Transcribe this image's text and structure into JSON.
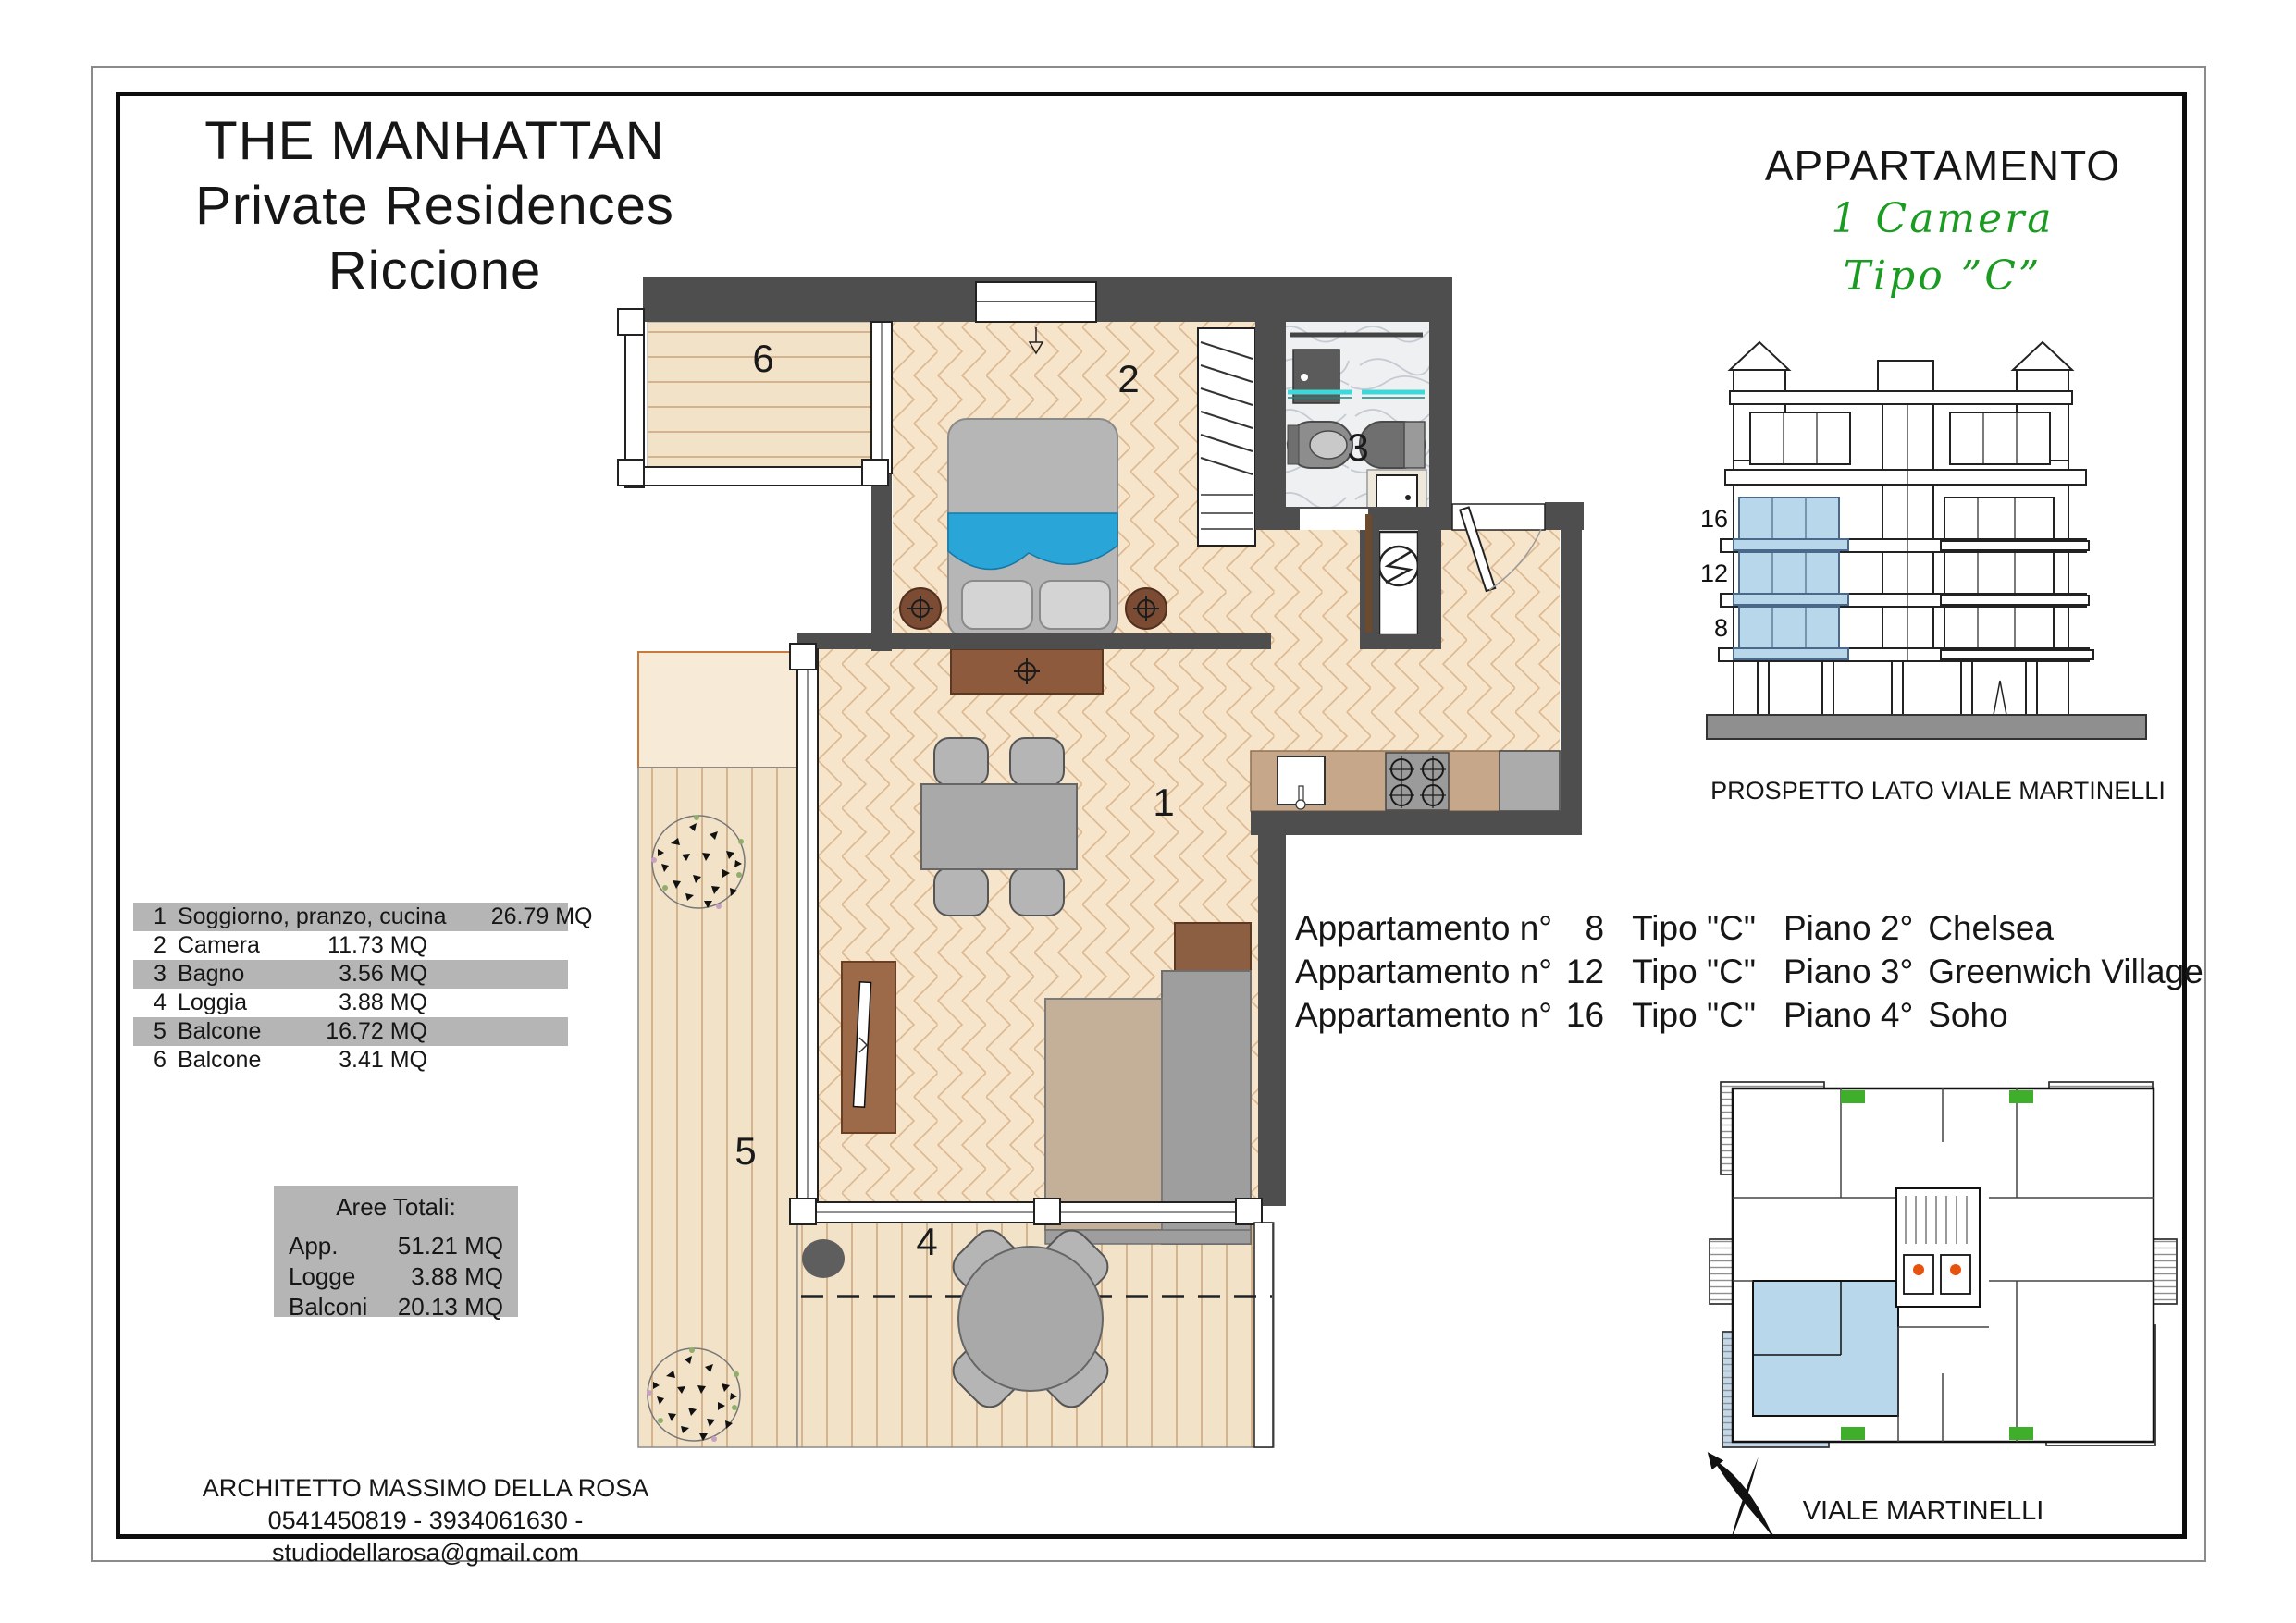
{
  "title": {
    "lines": [
      "THE MANHATTAN",
      "Private Residences",
      "Riccione"
    ]
  },
  "header_right": {
    "title": "APPARTAMENTO",
    "rooms_line": "1  Camera",
    "type_line": "Tipo  ”C”"
  },
  "elevation": {
    "caption": "PROSPETTO LATO VIALE MARTINELLI",
    "floors": [
      "16",
      "12",
      "8"
    ]
  },
  "legend": {
    "rows": [
      {
        "num": "1",
        "name": "Soggiorno, pranzo, cucina",
        "area": "26.79 MQ"
      },
      {
        "num": "2",
        "name": "Camera",
        "area": "11.73 MQ"
      },
      {
        "num": "3",
        "name": "Bagno",
        "area": "3.56 MQ"
      },
      {
        "num": "4",
        "name": "Loggia",
        "area": "3.88 MQ"
      },
      {
        "num": "5",
        "name": "Balcone",
        "area": "16.72 MQ"
      },
      {
        "num": "6",
        "name": "Balcone",
        "area": "3.41 MQ"
      }
    ]
  },
  "totals": {
    "title": "Aree Totali:",
    "rows": [
      {
        "label": "App.",
        "value": "51.21 MQ"
      },
      {
        "label": "Logge",
        "value": "3.88 MQ"
      },
      {
        "label": "Balconi",
        "value": "20.13 MQ"
      }
    ]
  },
  "apartments": {
    "rows": [
      {
        "prefix": "Appartamento n°",
        "num": "8",
        "tipo": "Tipo \"C\"",
        "piano": "Piano 2°",
        "zone": "Chelsea"
      },
      {
        "prefix": "Appartamento n°",
        "num": "12",
        "tipo": "Tipo \"C\"",
        "piano": "Piano 3°",
        "zone": "Greenwich Village"
      },
      {
        "prefix": "Appartamento n°",
        "num": "16",
        "tipo": "Tipo \"C\"",
        "piano": "Piano 4°",
        "zone": "Soho"
      }
    ]
  },
  "architect": {
    "name": "ARCHITETTO MASSIMO DELLA ROSA",
    "contacts": "0541450819 - 3934061630 - studiodellarosa@gmail.com"
  },
  "key_plan": {
    "street": "VIALE MARTINELLI"
  },
  "plan": {
    "room_labels": [
      "1",
      "2",
      "3",
      "4",
      "5",
      "6"
    ]
  },
  "colors": {
    "accent_green": "#1c9b23",
    "wall": "#4e4e4e",
    "floor": "#f6e4cb",
    "deck": "#f2e2c8",
    "marble": "#eef0f2",
    "teal": "#3fd8d8",
    "counter": "#c6a789",
    "highlight_blue": "#b9d7ea",
    "legend_shade": "#b5b5b5",
    "elevator_orange": "#e8520f"
  }
}
